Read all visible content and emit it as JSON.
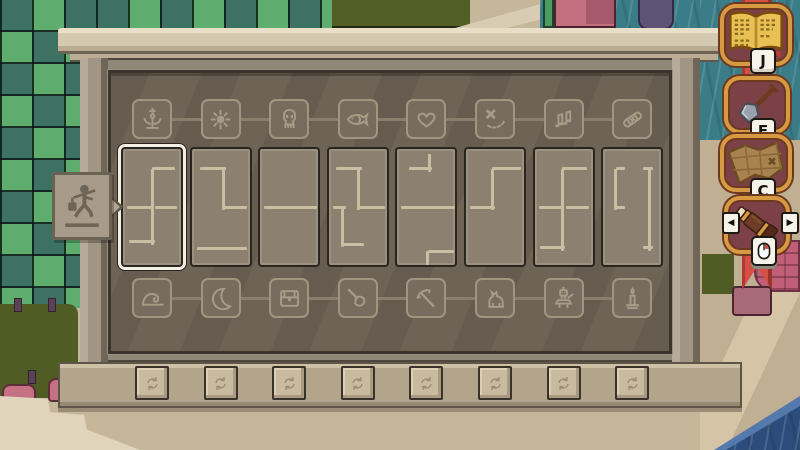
{
  "screen": {
    "type": "puzzle-board-minigame"
  },
  "board": {
    "selected_card_index": 0,
    "top_icons": [
      "monument",
      "sun",
      "skull",
      "fish",
      "heart",
      "treasure-x",
      "music-notes",
      "bandage"
    ],
    "bottom_icons": [
      "wave",
      "moon",
      "chest",
      "trowel",
      "pickaxe",
      "dog",
      "robot",
      "candle"
    ],
    "cards": [
      {
        "segments": [
          [
            0.5,
            0.17,
            0.5,
            0.8
          ],
          [
            0.5,
            0.17,
            0.85,
            0.17
          ],
          [
            0.07,
            0.5,
            0.44,
            0.5
          ],
          [
            0.56,
            0.5,
            0.88,
            0.5
          ],
          [
            0.1,
            0.8,
            0.5,
            0.8
          ]
        ]
      },
      {
        "segments": [
          [
            0.15,
            0.17,
            0.55,
            0.17
          ],
          [
            0.55,
            0.17,
            0.55,
            0.5
          ],
          [
            0.55,
            0.5,
            0.9,
            0.5
          ],
          [
            0.1,
            0.86,
            0.9,
            0.86
          ]
        ]
      },
      {
        "segments": [
          [
            0.07,
            0.5,
            0.93,
            0.5
          ]
        ]
      },
      {
        "segments": [
          [
            0.12,
            0.17,
            0.52,
            0.17
          ],
          [
            0.52,
            0.17,
            0.52,
            0.5
          ],
          [
            0.52,
            0.5,
            0.92,
            0.5
          ],
          [
            0.07,
            0.5,
            0.24,
            0.5
          ],
          [
            0.24,
            0.5,
            0.24,
            0.82
          ],
          [
            0.24,
            0.82,
            0.55,
            0.82
          ]
        ]
      },
      {
        "segments": [
          [
            0.55,
            0.04,
            0.55,
            0.17
          ],
          [
            0.2,
            0.17,
            0.55,
            0.17
          ],
          [
            0.06,
            0.5,
            0.94,
            0.5
          ],
          [
            0.52,
            0.88,
            0.93,
            0.88
          ],
          [
            0.52,
            0.88,
            0.52,
            0.97
          ]
        ]
      },
      {
        "segments": [
          [
            0.07,
            0.5,
            0.45,
            0.5
          ],
          [
            0.45,
            0.17,
            0.45,
            0.5
          ],
          [
            0.45,
            0.17,
            0.9,
            0.17
          ]
        ]
      },
      {
        "segments": [
          [
            0.48,
            0.17,
            0.48,
            0.85
          ],
          [
            0.48,
            0.17,
            0.85,
            0.17
          ],
          [
            0.07,
            0.5,
            0.42,
            0.5
          ],
          [
            0.55,
            0.5,
            0.88,
            0.5
          ],
          [
            0.1,
            0.85,
            0.48,
            0.85
          ]
        ]
      },
      {
        "segments": [
          [
            0.22,
            0.17,
            0.22,
            0.5
          ],
          [
            0.22,
            0.17,
            0.33,
            0.17
          ],
          [
            0.22,
            0.5,
            0.33,
            0.5
          ],
          [
            0.8,
            0.17,
            0.8,
            0.85
          ],
          [
            0.68,
            0.17,
            0.8,
            0.17
          ],
          [
            0.68,
            0.85,
            0.8,
            0.85
          ]
        ]
      }
    ],
    "rotate_button_icon": "rotate"
  },
  "sign": {
    "icon": "traveler"
  },
  "hud": {
    "items": [
      {
        "name": "journal",
        "icon": "book",
        "key": "J"
      },
      {
        "name": "shovel",
        "icon": "shovel",
        "key": "F"
      },
      {
        "name": "map",
        "icon": "map",
        "key": "C"
      },
      {
        "name": "spyglass",
        "icon": "spyglass",
        "key_hint": "mouse",
        "left_arrow": "◀",
        "right_arrow": "▶"
      }
    ]
  },
  "colors": {
    "banner_red": "#d44f44",
    "frame_gold": "#d79a43",
    "selection_highlight": "#f4efe3",
    "card_line": "#c9bda2",
    "board_panel": "#6e6456",
    "water_teal": "#3a7d88",
    "water_deep": "#2c4d7c",
    "canopy_light": "#5fae6f",
    "canopy_dark": "#3d7263"
  }
}
